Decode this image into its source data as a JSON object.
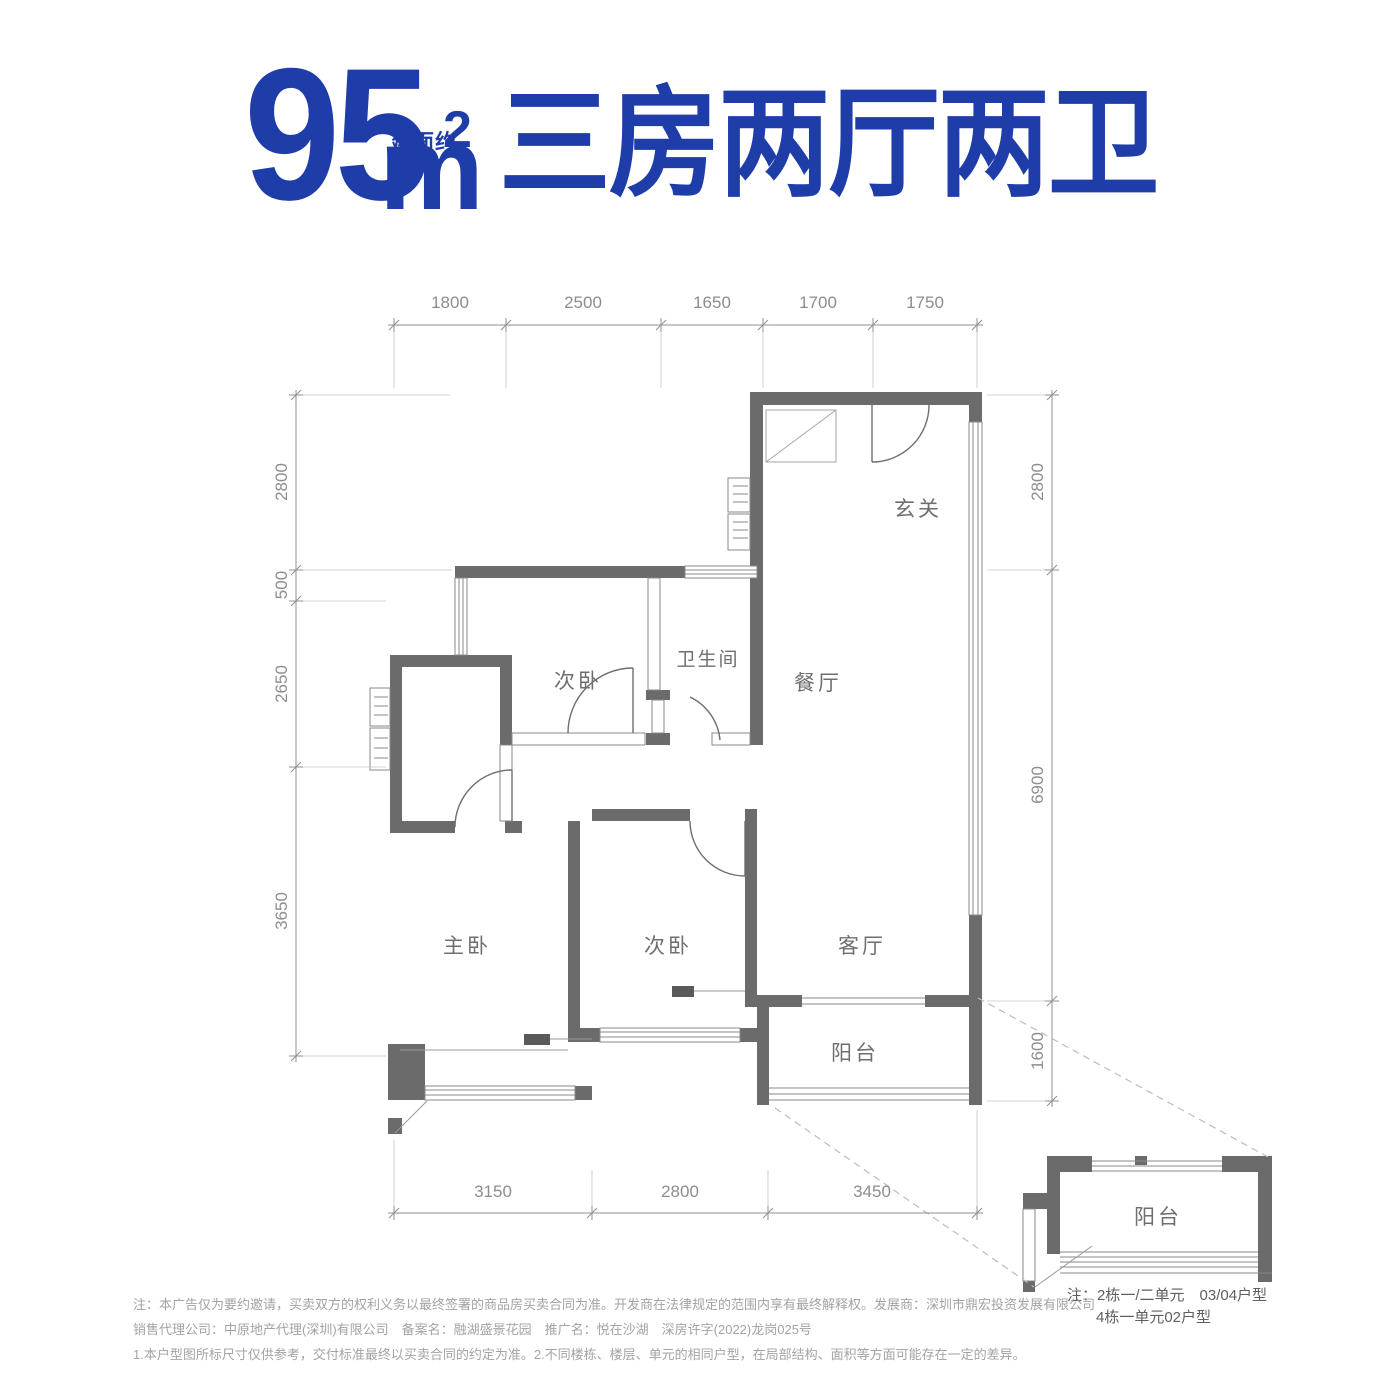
{
  "title": {
    "area_value": "95",
    "area_unit_prefix": "建面约",
    "area_unit": "m",
    "area_superscript": "2",
    "headline": "三房两厅两卫"
  },
  "colors": {
    "accent_blue": "#1e3da8",
    "wall_gray": "#6b6b6b",
    "dim_text_gray": "#8d8d8d",
    "room_text_gray": "#6f6f6f"
  },
  "dimensions": {
    "top": [
      "1800",
      "2500",
      "1650",
      "1700",
      "1750"
    ],
    "left": [
      "2800",
      "500",
      "2650",
      "3650"
    ],
    "right": [
      "2800",
      "6900",
      "1600"
    ],
    "bottom": [
      "3150",
      "2800",
      "3450"
    ]
  },
  "rooms": {
    "entry": "玄关",
    "bedroom_top": "次卧",
    "bathroom": "卫生间",
    "dining": "餐厅",
    "master": "主卧",
    "bedroom_bottom": "次卧",
    "living": "客厅",
    "balcony": "阳台"
  },
  "inset": {
    "balcony": "阳台",
    "note_line1": "注：2栋一/二单元　03/04户型",
    "note_line2": "4栋一单元02户型"
  },
  "disclaimer": {
    "line1": "注：本广告仅为要约邀请，买卖双方的权利义务以最终签署的商品房买卖合同为准。开发商在法律规定的范围内享有最终解释权。发展商：深圳市鼎宏投资发展有限公司",
    "line2": "销售代理公司：中原地产代理(深圳)有限公司　备案名：融湖盛景花园　推广名：悦在沙湖　深房许字(2022)龙岗025号",
    "line3": "1.本户型图所标尺寸仅供参考，交付标准最终以买卖合同的约定为准。2.不同楼栋、楼层、单元的相同户型，在局部结构、面积等方面可能存在一定的差异。"
  }
}
